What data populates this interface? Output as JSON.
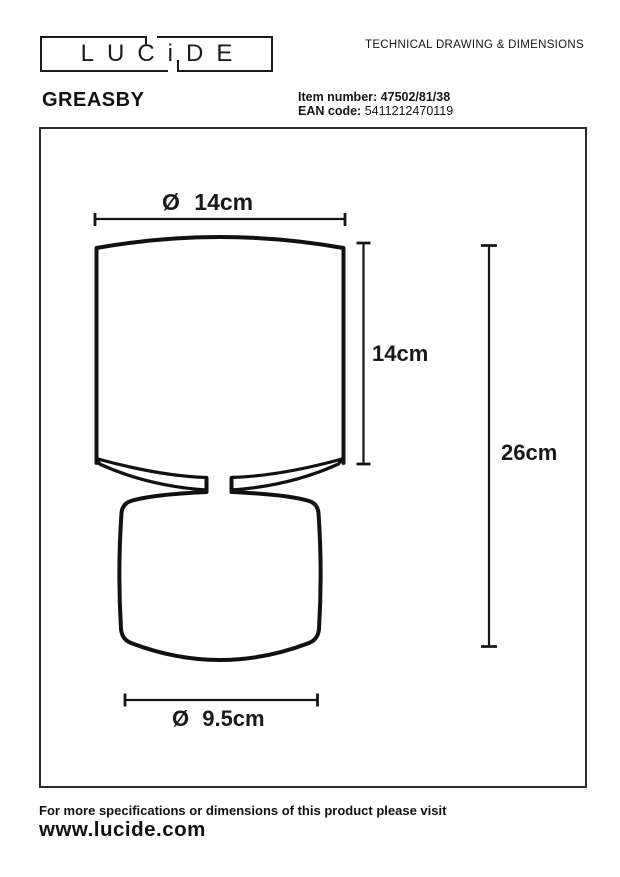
{
  "page": {
    "bg": "#ffffff",
    "ink": "#1a1a1a"
  },
  "header": {
    "logo_text": "LUCiDE",
    "doc_title": "TECHNICAL DRAWING & DIMENSIONS",
    "product_name": "GREASBY",
    "item": {
      "label": "Item number:",
      "value": "47502/81/38"
    },
    "ean": {
      "label": "EAN code:",
      "value": "5411212470119"
    }
  },
  "drawing": {
    "labels": {
      "top_diameter": "Ø 14cm",
      "shade_height": "14cm",
      "total_height": "26cm",
      "base_diameter": "Ø 9.5cm"
    }
  },
  "footer": {
    "note": "For more specifications or dimensions of this product please visit",
    "website": "www.lucide.com"
  }
}
